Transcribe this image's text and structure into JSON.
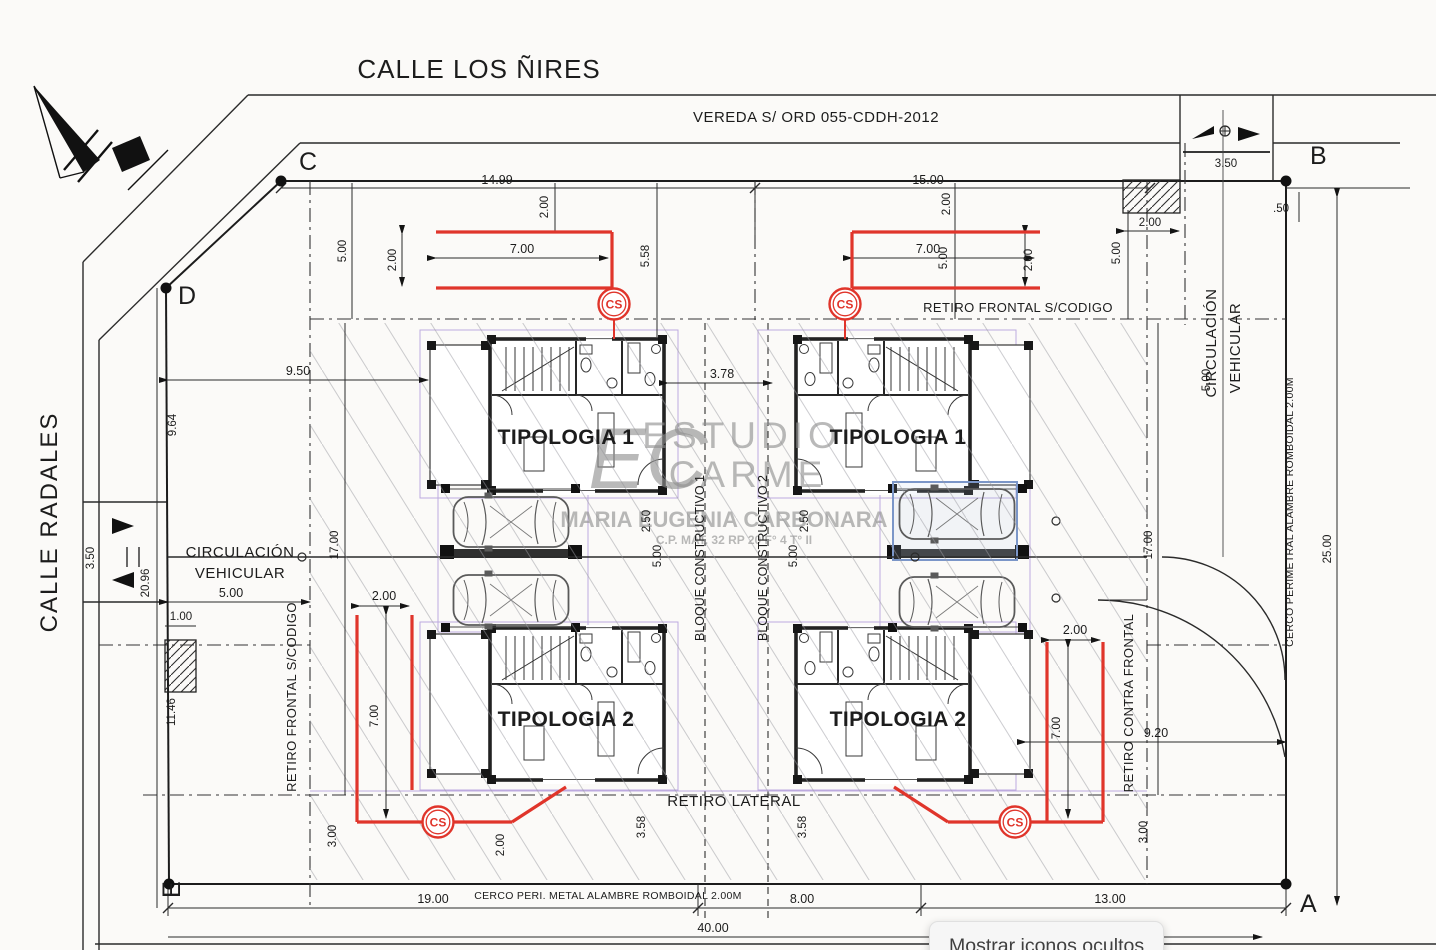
{
  "streets": {
    "top": "CALLE LOS ÑIRES",
    "left": "CALLE RADALES"
  },
  "corner_labels": {
    "a": "A",
    "b": "B",
    "c": "C",
    "d": "D",
    "e": "E"
  },
  "annotations": {
    "vereda": "VEREDA S/ ORD 055-CDDH-2012",
    "retiro_frontal_right": "RETIRO FRONTAL S/CODIGO",
    "retiro_frontal_left": "RETIRO FRONTAL S/CODIGO",
    "retiro_lateral": "RETIRO LATERAL",
    "retiro_contra_frontal": "RETIRO CONTRA FRONTAL",
    "cerco_perimetral_right": "CERCO PERIMETRAL ALAMBRE ROMBOIDAL 2.00M",
    "cerco_perimetral_bottom": "CERCO PERI. METAL ALAMBRE ROMBOIDAL 2.00M",
    "circulacion_line1": "CIRCULACIÓN",
    "circulacion_line2": "VEHICULAR",
    "bloque_1": "BLOQUE CONSTRUCTIVO 1",
    "bloque_2": "BLOQUE CONSTRUCTIVO 2",
    "cs": "CS"
  },
  "units": {
    "tipologia_1": "TIPOLOGIA 1",
    "tipologia_2": "TIPOLOGIA 2"
  },
  "dims": {
    "lot_left_width": "14.99",
    "lot_right_width": "15.00",
    "vereda_access_width": "3.50",
    "b_offset": ".50",
    "hatch_width": "2.00",
    "hatch_side": "5.00",
    "front_gap_left": "2.00",
    "front_gap_right": "2.00",
    "front_5_left": "5.00",
    "front_558": "5.58",
    "front_5_right": "5.00",
    "deck_top_left_len": "7.00",
    "deck_top_left_w": "2.00",
    "deck_top_right_len": "7.00",
    "deck_top_right_w": "2.00",
    "d950": "9.50",
    "d964": "9.64",
    "block_gap": "3.78",
    "d2096": "20.96",
    "radales_access_width": "3.50",
    "drive_width": "5.00",
    "d100": "1.00",
    "d1146": "11.46",
    "d17_left": "17.00",
    "d17_right": "17.00",
    "circ_5_right": "5.00",
    "carport_250_left": "2.50",
    "carport_500_left": "5.00",
    "carport_250_right": "2.50",
    "carport_500_right": "5.00",
    "d920": "9.20",
    "d25": "25.00",
    "d300_left": "3.00",
    "d300_right": "3.00",
    "d358_left": "3.58",
    "d358_right": "3.58",
    "d200_rear": "2.00",
    "deck_bottom_left_w": "2.00",
    "deck_bottom_left_len": "7.00",
    "deck_bottom_right_w": "2.00",
    "deck_bottom_right_len": "7.00",
    "bottom_seg1": "19.00",
    "bottom_seg2": "8.00",
    "bottom_seg3": "13.00",
    "bottom_total": "40.00"
  },
  "watermark": {
    "logo": "EC",
    "studio_line1": "ESTUDIO",
    "studio_line2": "CARME",
    "name": "MARIA EUGENIA CARBONARA",
    "registry": "C.P. MAT. 32 RP 20 F° 4 T° II"
  },
  "taskbar_tooltip": {
    "label": "Mostrar iconos ocultos"
  },
  "colors": {
    "red": "#e0352b",
    "lavender": "#b39ddb",
    "ink": "#262626"
  }
}
